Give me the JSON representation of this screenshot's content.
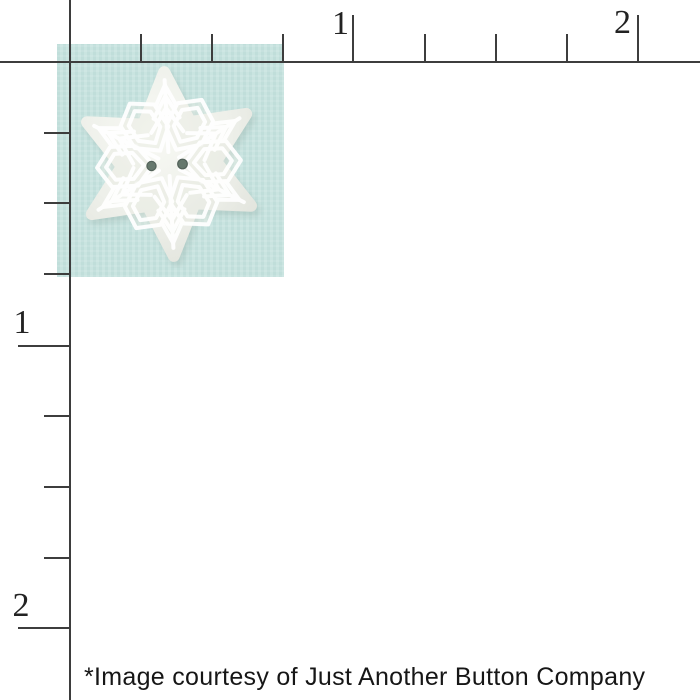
{
  "page": {
    "background_color": "#ffffff"
  },
  "ruler": {
    "line_color": "#3d3d3d",
    "top_labels": [
      "1",
      "2"
    ],
    "left_labels": [
      "1",
      "2"
    ]
  },
  "product_image": {
    "name": "snowflake button on aqua swatch",
    "swatch_color": "#c6e2de",
    "button": {
      "body_color": "#edefe9",
      "body_highlight_color": "#f8f9f4",
      "body_shade_color": "#e2e4dd",
      "pattern_color": "#ffffff",
      "cell_fill_color": "#e6e8e1",
      "hole_color": "#66786d",
      "hole_rim_color": "#53625a",
      "hole_count": 2,
      "shadow_color": "#93aba4"
    }
  },
  "caption": {
    "text": "*Image courtesy of Just Another Button Company",
    "color": "#161616"
  }
}
